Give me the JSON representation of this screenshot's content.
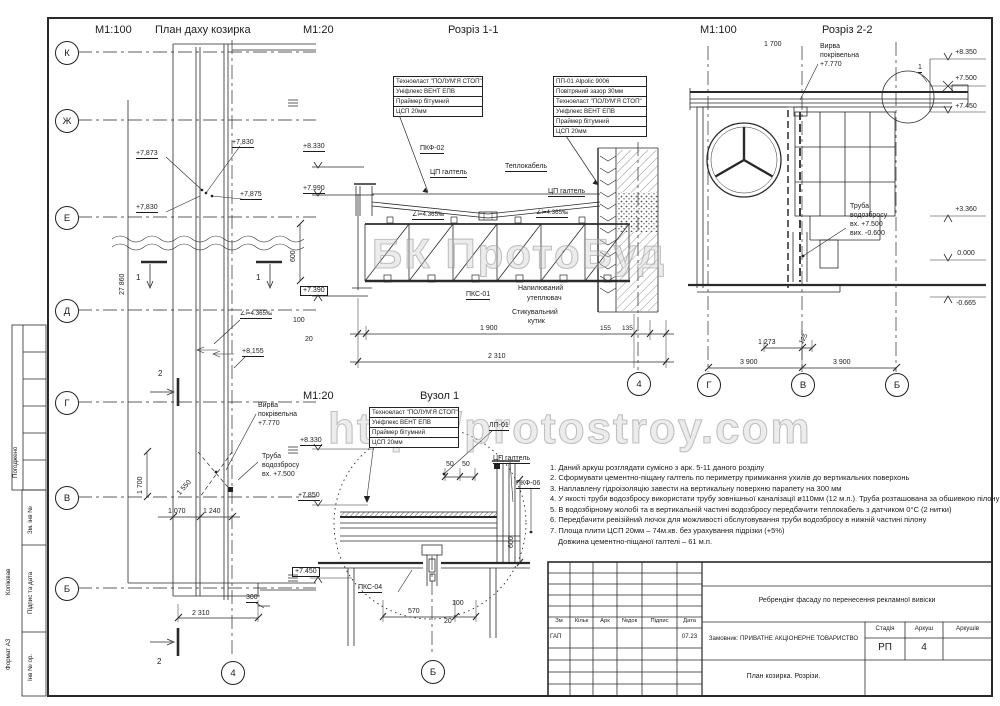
{
  "watermarks": {
    "brand": "БК ПротоБуд",
    "url": "http://protostroy.com"
  },
  "titles": {
    "plan_scale": "М1:100",
    "plan_title": "План даху козирка",
    "s11_scale": "М1:20",
    "s11_title": "Розріз 1-1",
    "s22_scale": "М1:100",
    "s22_title": "Розріз 2-2",
    "node_scale": "М1:20",
    "node_title": "Вузол 1"
  },
  "materials": {
    "stack4": [
      "Техноеласт \"ПОЛУМ'Я СТОП\"",
      "Уніфлекс ВЕНТ ЕПВ",
      "Праймер бітумний",
      "ЦСП 20мм"
    ],
    "stack6": [
      "ПП-01 Alpolic 9006",
      "Повітряний зазор 30мм",
      "Техноеласт \"ПОЛУМ'Я СТОП\"",
      "Уніфлекс ВЕНТ ЕПВ",
      "Праймер бітумний",
      "ЦСП 20мм"
    ]
  },
  "plan": {
    "axes": [
      "К",
      "Ж",
      "Е",
      "Д",
      "Г",
      "В",
      "Б"
    ],
    "axis4": "4",
    "elev_7873": "+7,873",
    "elev_7830a": "+7,830",
    "elev_7875": "+7,875",
    "elev_7830b": "+7,830",
    "slope": "∠i=4.365‰",
    "elev_8155": "+8,155",
    "mark1": "1",
    "mark2": "2",
    "dim_27860": "27 860",
    "dim_1700": "1 700",
    "dim_1550": "1 550",
    "dim_1070": "1 070",
    "dim_1240": "1 240",
    "dim_2310": "2 310",
    "dim_300": "300",
    "funnel": [
      "Вирва",
      "покрівельна",
      "+7.770"
    ],
    "pipe": [
      "Труба",
      "водозбросу",
      "вх. +7.500"
    ]
  },
  "s11": {
    "elev_8330": "+8.330",
    "elev_7990": "+7.990",
    "elev_7390": "+7.390",
    "pkf02": "ПКФ-02",
    "galtel_l": "ЦП галтель",
    "teplokabel": "Теплокабель",
    "galtel_r": "ЦП галтель",
    "slope_l": "∠i=4.365‰",
    "slope_r": "∠i=4.365‰",
    "dim_600": "600",
    "pks01": "ПКС-01",
    "insul": [
      "Напилюваний",
      "утеплювач"
    ],
    "kutyk": [
      "Стикувальний",
      "кутик"
    ],
    "dim_100": "100",
    "dim_20": "20",
    "dim_1900": "1 900",
    "dim_155": "155",
    "dim_135": "135",
    "dim_2310": "2 310",
    "axis4": "4"
  },
  "s22": {
    "dim_1700": "1 700",
    "funnel": [
      "Вирва",
      "покрівельна",
      "+7.770"
    ],
    "detail_mark": "1",
    "elevs": [
      "+8.350",
      "+7.500",
      "+7.450",
      "+3.360",
      "0.000",
      "-0.665"
    ],
    "pipe": [
      "Труба",
      "водозбросу",
      "вх.  +7.500",
      "вих. -0.600"
    ],
    "dim_1273": "1 273",
    "dim_125": "125",
    "dim_3900a": "3 900",
    "dim_3900b": "3 900",
    "axes": [
      "Г",
      "В",
      "Б"
    ]
  },
  "node1": {
    "elev_8330": "+8.330",
    "elev_7850": "+7.850",
    "elev_7450": "+7.450",
    "lp01": "ЛП-01",
    "galtel": "ЦП галтель",
    "pkf06": "ПКФ-06",
    "pks04": "ПКС-04",
    "dim_50a": "50",
    "dim_50b": "50",
    "dim_600": "600",
    "dim_570": "570",
    "dim_100": "100",
    "dim_20": "20",
    "axisB": "Б"
  },
  "notes": {
    "lines": [
      "1. Даний аркуш розглядати сумісно з арк. 5-11 даного розділу",
      "2. Сформувати цементно-піщану галтель по периметру примикання ухилів до вертикальних поверхонь",
      "3. Наплавлену гідроізоляцію завести на вертикальну поверхню парапету на 300 мм",
      "4. У якості труби водозбросу використати трубу зовнішньої каналізації ø110мм (12 м.п.). Труба розташована за обшивкою пілону",
      "5. В водозбірному жолобі та в вертикальній частині водозбросу передбачити теплокабель з датчиком 0°С (2 нитки)",
      "6. Передбачити ревізійний лючок для можливості обслуговування труби водозбросу в нижній частині пілону",
      "7. Площа плити ЦСП 20мм – 74м.кв. без урахування підрізки (+5%)",
      "Довжина цементно-піщаної галтелі – 61 м.п."
    ]
  },
  "titleblock": {
    "cols": [
      "Зм",
      "Кільк",
      "Арк",
      "№док",
      "Підпис",
      "Дата"
    ],
    "gap": "ГАП",
    "date": "07.23",
    "project": "Ребрендінг фасаду по перенесення рекламної вивіски",
    "client": "Замовник: ПРИВАТНЕ АКЦІОНЕРНЕ ТОВАРИСТВО",
    "stage_label": "Стадія",
    "sheet_label": "Аркуш",
    "sheets_label": "Аркушів",
    "stage": "РП",
    "sheet_no": "4",
    "doc_title": "План козирка. Розрізи."
  },
  "margin": {
    "pogodzheno": "Погоджено",
    "zm_inv": "Зм. інв №",
    "pidpys_data": "Підпис та дата",
    "inv_or": "Інв № ор.",
    "kopiyuvav": "Копіював",
    "format": "Формат А3"
  }
}
